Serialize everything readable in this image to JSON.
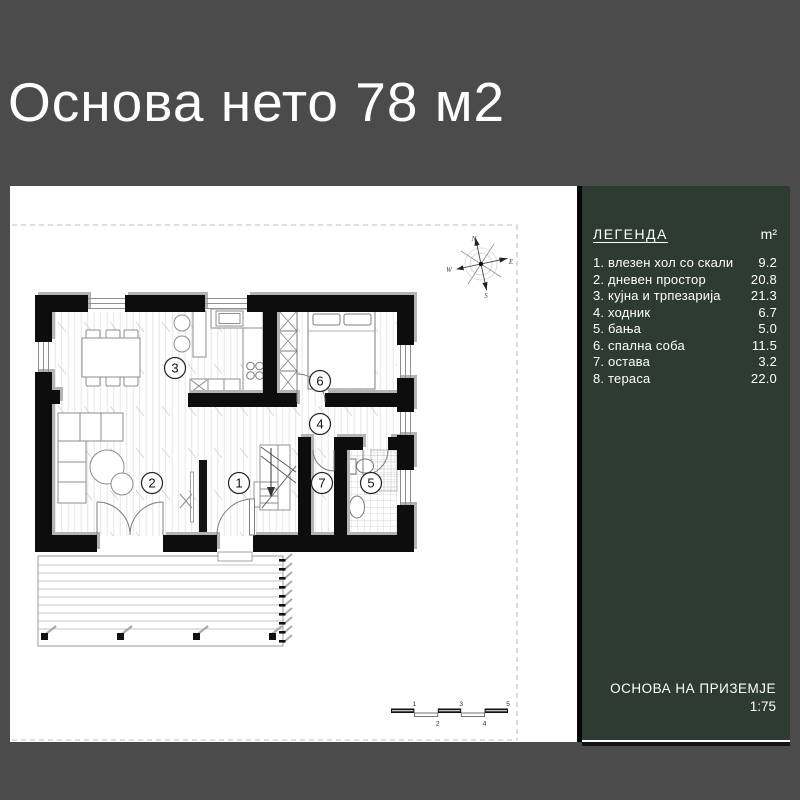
{
  "header": {
    "title": "Основа нето 78 м2"
  },
  "legend": {
    "title": "ЛЕГЕНДА",
    "unit": "m²",
    "items": [
      {
        "label": "1. влезен хол со скали",
        "value": "9.2"
      },
      {
        "label": "2. дневен простор",
        "value": "20.8"
      },
      {
        "label": "3. кујна и трпезарија",
        "value": "21.3"
      },
      {
        "label": "4. ходник",
        "value": "6.7"
      },
      {
        "label": "5. бања",
        "value": "5.0"
      },
      {
        "label": "6. спална соба",
        "value": "11.5"
      },
      {
        "label": "7. остава",
        "value": "3.2"
      },
      {
        "label": "8. тераса",
        "value": "22.0"
      }
    ],
    "footer_title": "ОСНОВА НА ПРИЗЕМЈЕ",
    "footer_scale": "1:75"
  },
  "plan": {
    "rooms": [
      {
        "num": "1"
      },
      {
        "num": "2"
      },
      {
        "num": "3"
      },
      {
        "num": "4"
      },
      {
        "num": "5"
      },
      {
        "num": "6"
      },
      {
        "num": "7"
      }
    ],
    "compass": {
      "n": "N",
      "e": "E",
      "w": "W",
      "s": "S"
    },
    "scalebar": [
      "1",
      "2",
      "3",
      "4",
      "5"
    ]
  },
  "colors": {
    "background": "#4b4b4b",
    "panel_green": "#2e3b31",
    "paper": "#ffffff",
    "wall": "#0d0d0d"
  }
}
